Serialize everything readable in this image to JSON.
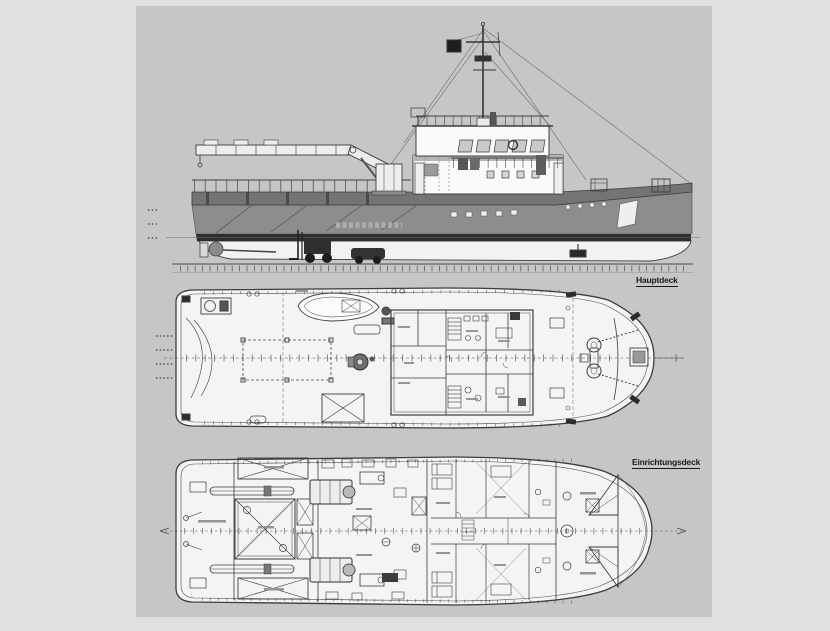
{
  "scan": {
    "page_background": "#e0e1df",
    "scan_background": "#c6c7c5",
    "description": "Scanned general arrangement drawing of a twin-screw work boat / tug: side elevation, main deck plan, lower deck plan"
  },
  "views": {
    "side_elevation": {
      "name": "side elevation"
    },
    "main_deck": {
      "label": "Hauptdeck"
    },
    "lower_deck": {
      "label": "Einrichtungsdeck"
    }
  },
  "colors": {
    "linework": "#3d3d3d",
    "hull_bulwark": "#747474",
    "hull_side": "#8d8d8d",
    "boot_stripe": "#2e2e2e",
    "underwater_hull": "#f2f2f2",
    "deck_fill": "#f4f4f3",
    "text_smudge": "#949494"
  }
}
